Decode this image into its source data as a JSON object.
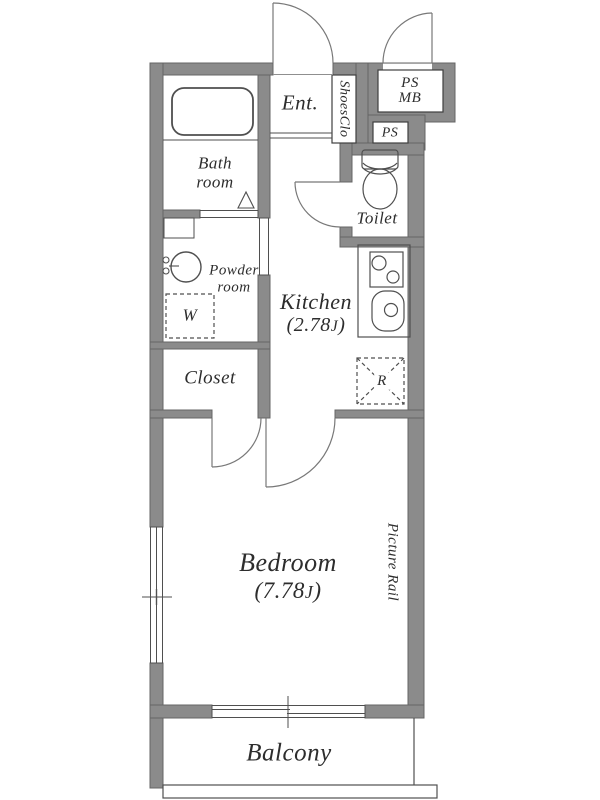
{
  "title": "1K apartment floor plan",
  "colors": {
    "background": "#ffffff",
    "wall_fill": "#8b8b8b",
    "wall_edge": "#656565",
    "line": "#4f4f4f",
    "door_line": "#787878",
    "text": "#2d2d2d"
  },
  "rooms": {
    "entrance": {
      "label": "Ent."
    },
    "shoes_closet": {
      "label": "ShoesClo"
    },
    "pipe_space_meter_box": {
      "line1": "PS",
      "line2": "MB"
    },
    "pipe_space": {
      "label": "PS"
    },
    "toilet": {
      "label": "Toilet"
    },
    "bathroom": {
      "line1": "Bath",
      "line2": "room"
    },
    "powder_room": {
      "line1": "Powder",
      "line2": "room"
    },
    "washer": {
      "label": "W"
    },
    "kitchen": {
      "label": "Kitchen",
      "size_open": "(2.78",
      "size_unit": "J",
      "size_close": ")"
    },
    "closet": {
      "label": "Closet"
    },
    "refrigerator": {
      "label": "R"
    },
    "bedroom": {
      "label": "Bedroom",
      "size_open": "(7.78",
      "size_unit": "J",
      "size_close": ")"
    },
    "picture_rail": {
      "label": "Picture Rail"
    },
    "balcony": {
      "label": "Balcony"
    }
  }
}
